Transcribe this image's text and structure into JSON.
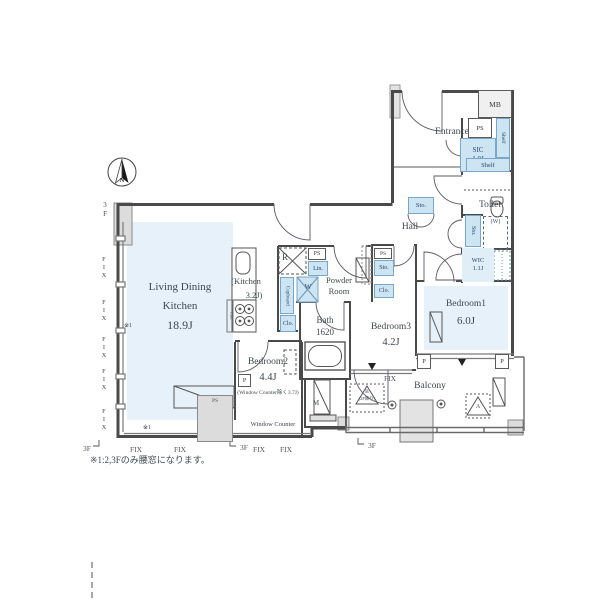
{
  "rooms": {
    "ldk_line1": "Living Dining",
    "ldk_line2": "Kitchen",
    "ldk_size": "18.9J",
    "kitchen_line1": "(Kitchen",
    "kitchen_line2": "3.2J)",
    "bedroom1": "Bedroom1",
    "bedroom1_size": "6.0J",
    "bedroom2": "Bedroom2",
    "bedroom2_size": "4.4J",
    "bedroom2_note": "(Window Counter除く3.7J)",
    "bedroom3": "Bedroom3",
    "bedroom3_size": "4.2J",
    "bath": "Bath",
    "bath_size": "1620",
    "powder_line1": "Powder",
    "powder_line2": "Room",
    "toilet": "Toilet",
    "entrance": "Entrance",
    "hall": "Hall",
    "balcony": "Balcony",
    "sic_name": "SIC",
    "sic_size": "1.0J",
    "wic_name": "WIC",
    "wic_size": "1.1J",
    "window_counter": "Window Counter"
  },
  "fixtures": {
    "mb": "MB",
    "ps": "PS",
    "lin": "Lin.",
    "sto": "Sto.",
    "clo": "Clo.",
    "shelf": "Shelf",
    "cupboard": "Cupboard",
    "refrigerator": "R",
    "washer": "W",
    "washer_future": "(W)",
    "meter": "M",
    "pillar": "P",
    "hatch_a": "A",
    "hatch_b": "B",
    "hatch_b_note": "(2F降り)"
  },
  "marks": {
    "fix": "FIX",
    "floor": "3F",
    "ref": "※1",
    "north": "N",
    "note": "※1:2,3Fのみ腰窓になります。"
  },
  "colors": {
    "room_fill": "#e7f1f9",
    "fixture_fill": "#cde5f3",
    "fixture_border": "#79a7c7",
    "wall": "#4a4a4a"
  }
}
